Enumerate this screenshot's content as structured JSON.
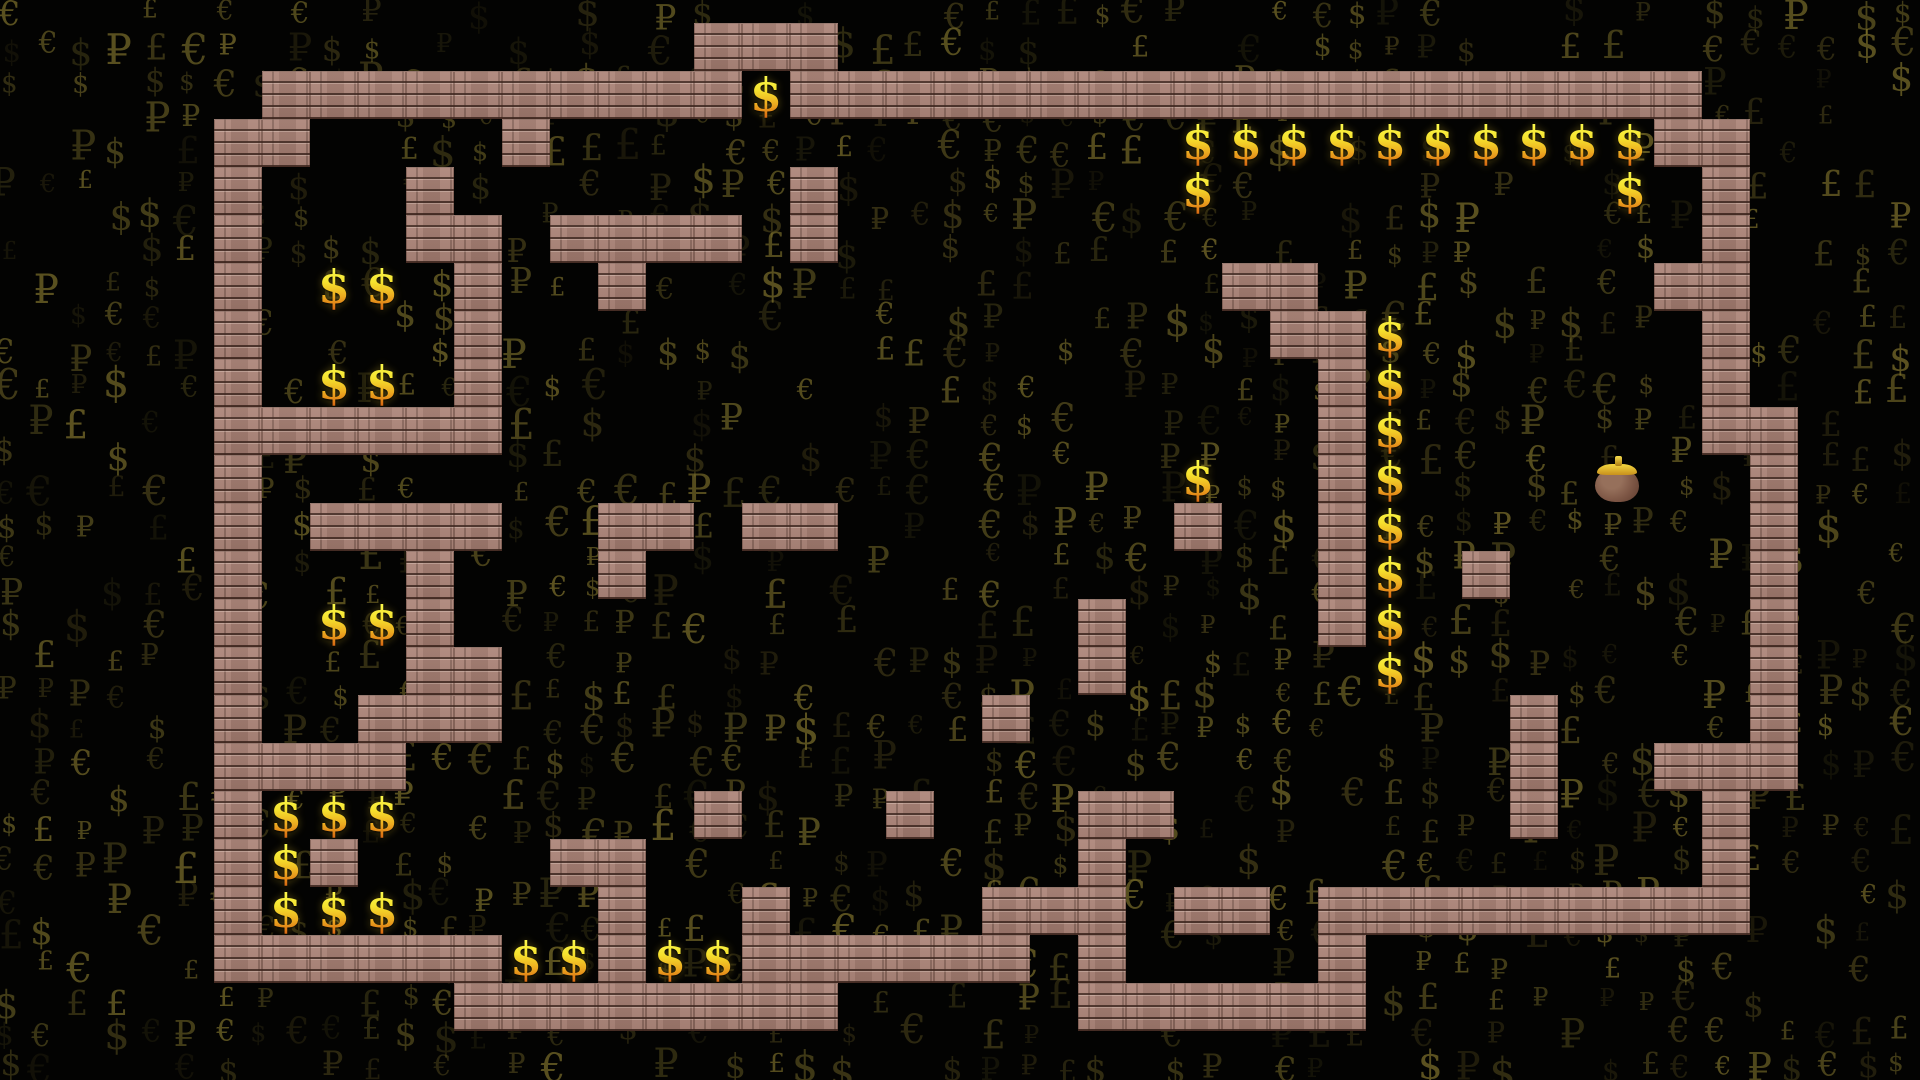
{
  "game": {
    "viewport": {
      "width": 1920,
      "height": 1080
    },
    "grid": {
      "tile_size": 48,
      "origin_x": 22,
      "origin_y": 23,
      "cols": 40,
      "rows": 22,
      "legend": {
        "#": "brick-wall",
        ".": "floor",
        "$": "coin",
        "B": "money-purse"
      },
      "map_rows": [
        "..............###.......................",
        ".....##########$###################.....",
        "....##....#.............$$$$$$$$$$##....",
        "....#...#.......#.......$........$.#....",
        "....#...##.####.#..................#....",
        "....#.$$.#..#............##.......##....",
        "....#....#................##$......#....",
        "....#.$$.#.................#$......#....",
        "....######.................#$......##...",
        "....#...................$..#$....B..#...",
        "....#.####..##.##.......#..#$.......#...",
        "....#...#...#..............#$.#.....#...",
        "....#.$$#.............#....#$.......#...",
        "....#...##............#.....$.......#...",
        "....#..###..........#..........#....#...",
        "....####.......................#..###...",
        "....#$$$......#...#...##.......#...#....",
        "....#$#....##.........#............#....",
        "....#$$$....#..#....###.##.#########....",
        "....######$$#$$######.#....#............",
        ".........########.....######............",
        "........................................"
      ]
    },
    "sprites": {
      "coin_glyph": "$",
      "coin_count": 39,
      "money_purse_count": 1
    },
    "colors": {
      "background": "#030302",
      "brick": "#a87f73",
      "brick_highlight": "#c9a294",
      "mortar": "#5e4138",
      "coin_gold_top": "#fbf84a",
      "coin_gold_bottom": "#da6d13",
      "glyph_olive": "#8a7c30",
      "purse_body": "#7c5544",
      "purse_clasp": "#e8c12e"
    },
    "background_pattern": {
      "symbols": [
        "$",
        "€",
        "₽",
        "£"
      ],
      "grid_cols": 53,
      "grid_rows": 32,
      "spacing_x": 36.4,
      "spacing_y": 34,
      "fill_ratio": 0.62,
      "seed": 7
    }
  }
}
